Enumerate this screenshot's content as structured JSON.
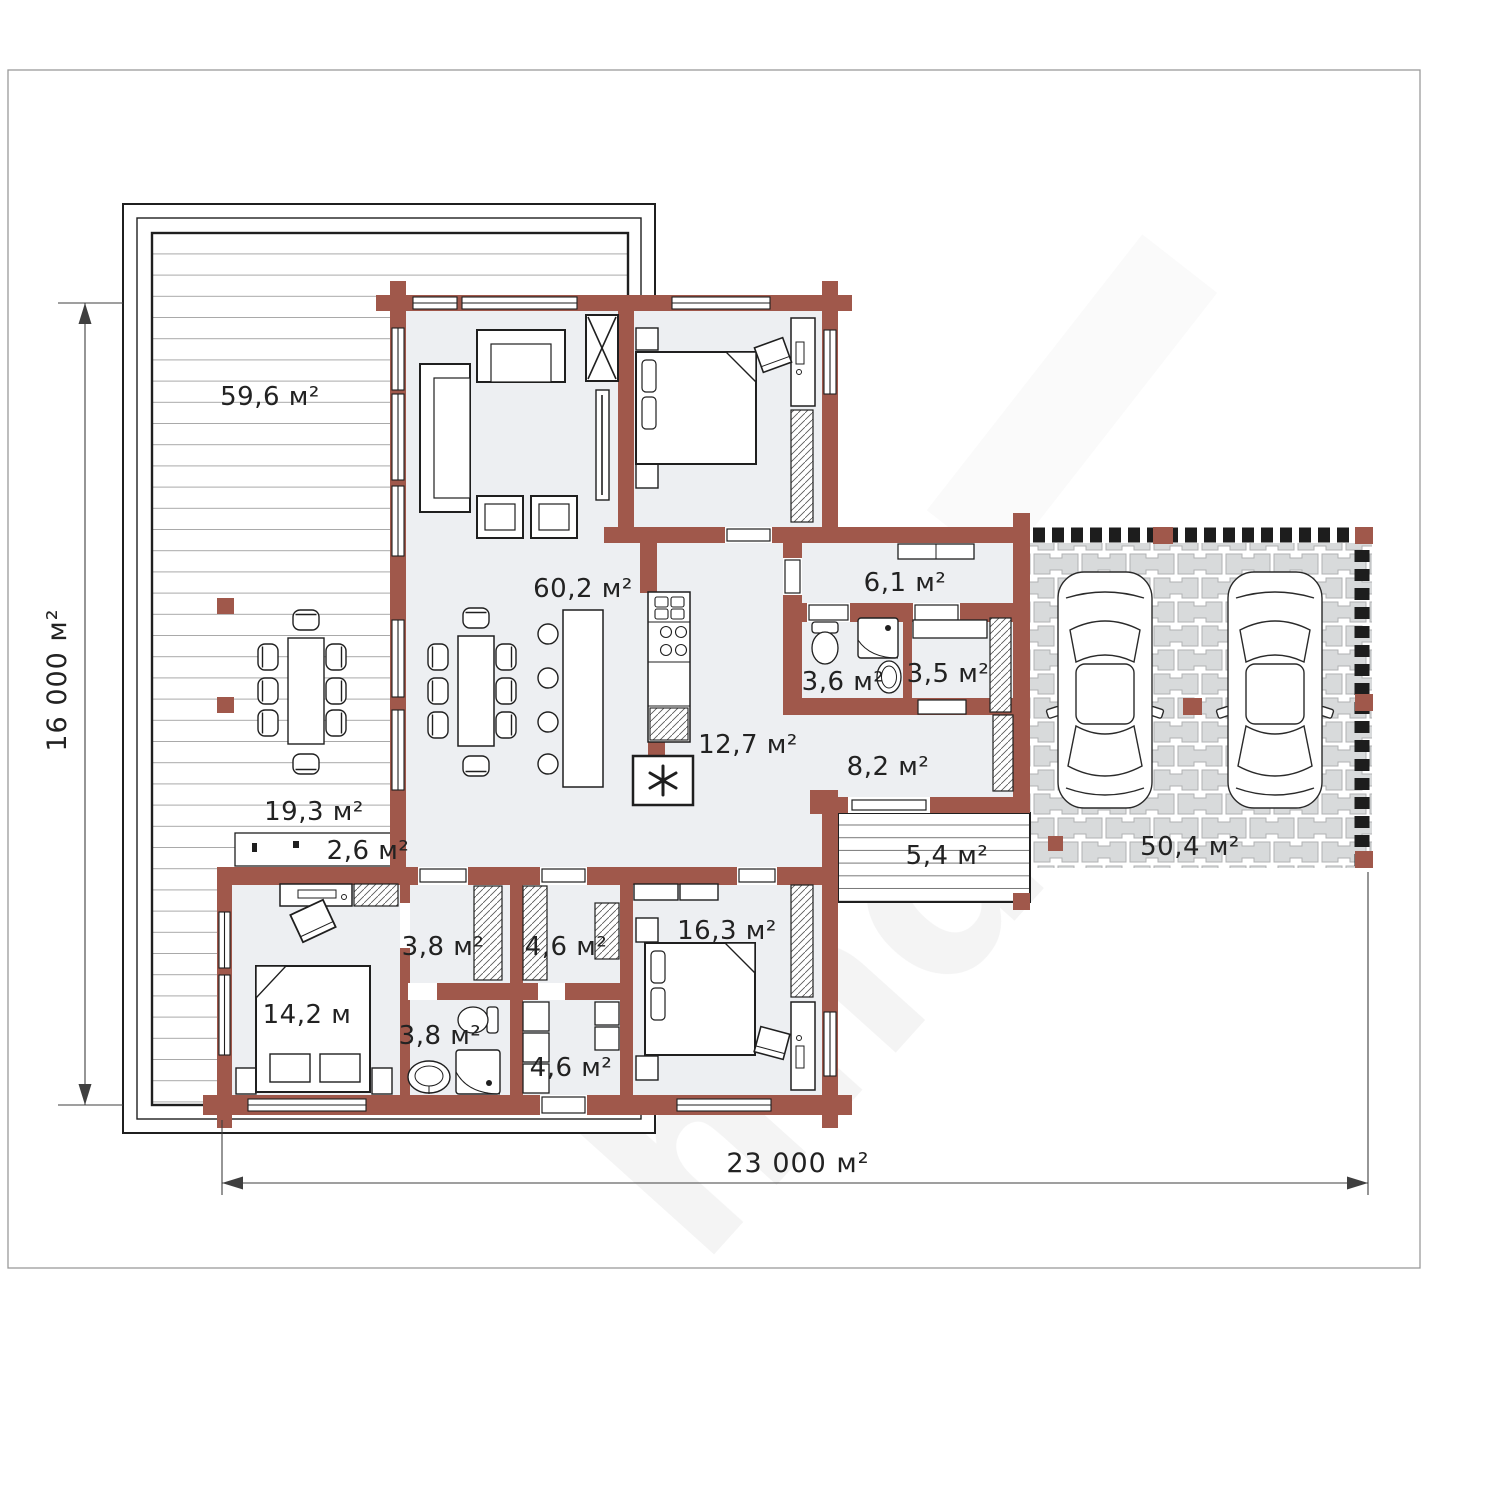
{
  "colors": {
    "wall": "#a0584b",
    "floor": "#edeff2",
    "line": "#1f1f1f",
    "plank": "#a8a8a8",
    "dim": "#3f3f3f",
    "text": "#222222"
  },
  "rooms": {
    "deck": {
      "area": "59,6 м²"
    },
    "terrace": {
      "area": "19,3 м²"
    },
    "planter": {
      "area": "2,6 м²"
    },
    "living": {
      "area": "60,2 м²"
    },
    "entry_hall": {
      "area": "6,1 м²"
    },
    "wc": {
      "area": "3,6 м²"
    },
    "closet_small": {
      "area": "3,5 м²"
    },
    "kitchen_corridor": {
      "area": "12,7 м²"
    },
    "hallway": {
      "area": "8,2 м²"
    },
    "porch": {
      "area": "5,4 м²"
    },
    "carport": {
      "area": "50,4 м²"
    },
    "storage_top": {
      "area": "3,8 м²"
    },
    "bathroom": {
      "area": "3,8 м²"
    },
    "wardrobe_top": {
      "area": "4,6 м²"
    },
    "laundry": {
      "area": "4,6 м²"
    },
    "bedroom_right": {
      "area": "16,3 м²"
    },
    "bedroom_left": {
      "area": "14,2 м"
    }
  },
  "dimensions": {
    "height": "16 000 м²",
    "width": "23 000 м²"
  },
  "watermark": "hndi"
}
